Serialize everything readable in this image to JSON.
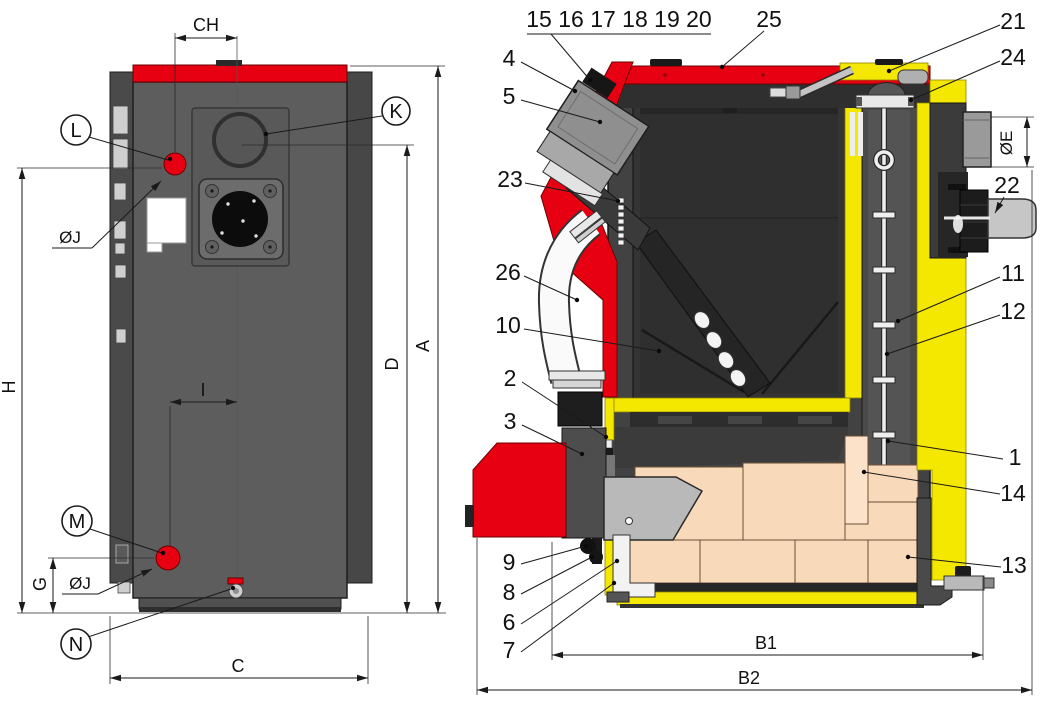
{
  "rear_view": {
    "callouts": {
      "l": "L",
      "k": "K",
      "m": "M",
      "n": "N"
    },
    "dims": {
      "ch": "CH",
      "h": "H",
      "g": "G",
      "i": "I",
      "c": "C",
      "d": "D",
      "a": "A",
      "dia_top": "ØJ",
      "dia_bottom": "ØJ"
    }
  },
  "section_view": {
    "burner_group_label": "15 16 17 18 19 20",
    "parts": {
      "p1": "1",
      "p2": "2",
      "p3": "3",
      "p4": "4",
      "p5": "5",
      "p6": "6",
      "p7": "7",
      "p8": "8",
      "p9": "9",
      "p10": "10",
      "p11": "11",
      "p12": "12",
      "p13": "13",
      "p14": "14",
      "p21": "21",
      "p22": "22",
      "p23": "23",
      "p24": "24",
      "p25": "25",
      "p26": "26"
    },
    "dims": {
      "b1": "B1",
      "b2": "B2",
      "dia_e": "ØE"
    }
  },
  "colors": {
    "accent_red": "#e60012",
    "accent_yellow": "#f5e800",
    "rear_panel_gray": "#5d5d5d",
    "side_panel_gray": "#4a4a4a",
    "section_body_gray": "#424242",
    "firebox_gray": "#2f2f2f",
    "firebrick_beige": "#f8d9ba",
    "tube_white": "#fafafa"
  }
}
